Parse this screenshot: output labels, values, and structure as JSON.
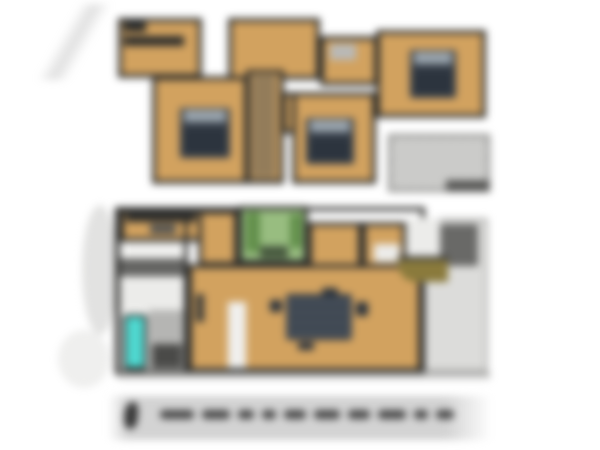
{
  "scene": {
    "kind": "blurred floor-plan photograph",
    "floor_count": 2,
    "background": "#ffffff"
  },
  "upper_floor": {
    "features": [
      "three beds",
      "stairs",
      "hall",
      "gray deck lower-right"
    ],
    "bed_count": 3
  },
  "ground_floor": {
    "features": [
      "kitchen counter",
      "green rug room with plants",
      "dining table",
      "bathtub",
      "stairs",
      "patio right side",
      "olive curved counter"
    ]
  },
  "caption": {
    "bar_visible": true,
    "logo_visible": true,
    "text_legible": false,
    "word_blob_count": 10
  },
  "palette": {
    "wood": "#d2a25f",
    "wall": "#2f2f2d",
    "bed": "#39414b",
    "pillow": "#9aa5ae",
    "green_rug": "#98bd80",
    "plant": "#628f4b",
    "teal_bathtub": "#4fd8d0",
    "olive_counter": "#8a7a3c",
    "deck_gray": "#cbcbc9",
    "patio_gray": "#dcdcda",
    "dark_block_gray": "#696967",
    "caption_bar": "#d3d3d3",
    "caption_ink": "#474747"
  }
}
